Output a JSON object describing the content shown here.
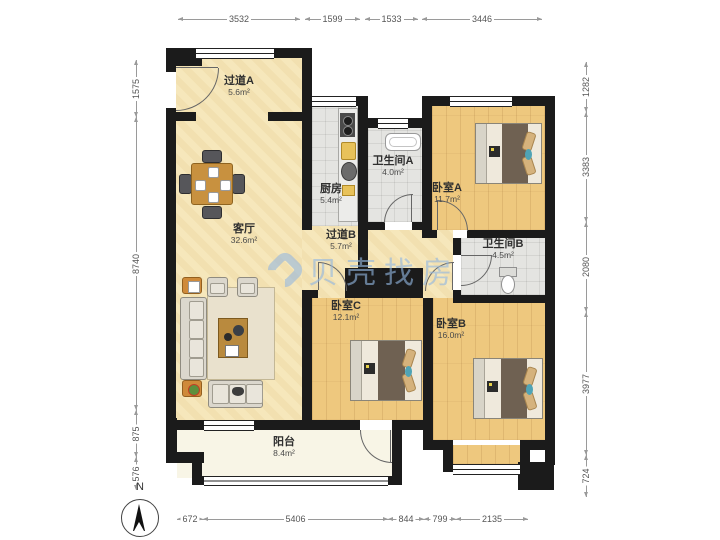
{
  "rooms": [
    {
      "id": "hallway-a",
      "name": "过道A",
      "area": "5.6m²"
    },
    {
      "id": "kitchen",
      "name": "厨房",
      "area": "5.4m²"
    },
    {
      "id": "bathroom-a",
      "name": "卫生间A",
      "area": "4.0m²"
    },
    {
      "id": "bedroom-a",
      "name": "卧室A",
      "area": "11.7m²"
    },
    {
      "id": "living-room",
      "name": "客厅",
      "area": "32.6m²"
    },
    {
      "id": "hallway-b",
      "name": "过道B",
      "area": "5.7m²"
    },
    {
      "id": "bathroom-b",
      "name": "卫生间B",
      "area": "4.5m²"
    },
    {
      "id": "bedroom-c",
      "name": "卧室C",
      "area": "12.1m²"
    },
    {
      "id": "bedroom-b",
      "name": "卧室B",
      "area": "16.0m²"
    },
    {
      "id": "balcony",
      "name": "阳台",
      "area": "8.4m²"
    }
  ],
  "dimensions_mm": {
    "top": [
      "3532",
      "1599",
      "1533",
      "3446"
    ],
    "bottom": [
      "672",
      "5406",
      "844",
      "799",
      "2135"
    ],
    "left": [
      "1575",
      "8740",
      "875",
      "576"
    ],
    "right": [
      "1282",
      "3383",
      "2080",
      "3977",
      "724"
    ]
  },
  "compass": {
    "label": "N"
  },
  "watermark": {
    "text": "贝壳找房"
  },
  "colors": {
    "wall": "#1b1b1b",
    "floor_main": "#f6e7bb",
    "floor_wood": "#eec87e",
    "floor_tile": "#e4e4e1",
    "floor_balcony": "#f8f5e6",
    "watermark": "#92b6e0",
    "dimension_text": "#555555"
  }
}
